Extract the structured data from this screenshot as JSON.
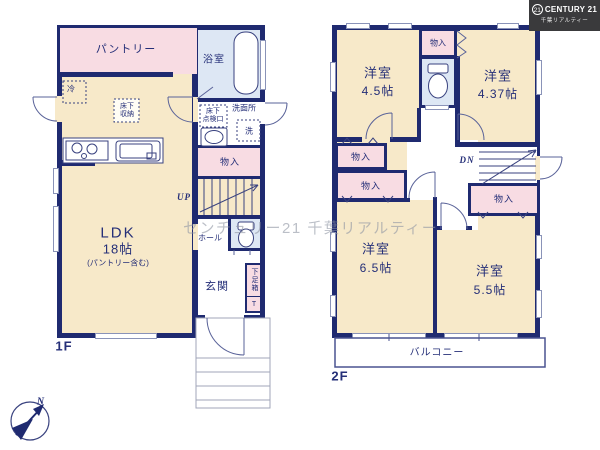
{
  "branding": {
    "badge": "21",
    "name": "CENTURY 21",
    "subtitle": "千葉リアルティー"
  },
  "watermark": {
    "text": "センチュリー21 千葉リアルティー"
  },
  "compass": {
    "north": "N"
  },
  "colors": {
    "wall_navy": "#1f2a70",
    "room_cream": "#f7e9c9",
    "room_pink": "#f8dce3",
    "room_blue": "#dde7f4",
    "logo_bg": "#3a3a3c"
  },
  "f1": {
    "floor_label": "1F",
    "pantry": "パントリー",
    "bath": "浴室",
    "fridge": "冷",
    "underfloor_storage": "床下\n収納",
    "underfloor_hatch": "床下\n点検口",
    "washroom": "洗面所",
    "washer": "洗",
    "closet": "物入",
    "up": "UP",
    "hall": "ホール",
    "ldk_name": "LDK",
    "ldk_size": "18帖",
    "ldk_note": "(パントリー含む)",
    "entrance": "玄関",
    "shoe_box": "下足箱",
    "shoe_box_t": "T"
  },
  "f2": {
    "floor_label": "2F",
    "closet": "物入",
    "dn": "DN",
    "balcony": "バルコニー",
    "rooms": {
      "a": {
        "name": "洋室",
        "size": "4.5帖"
      },
      "b": {
        "name": "洋室",
        "size": "4.37帖"
      },
      "c": {
        "name": "洋室",
        "size": "6.5帖"
      },
      "d": {
        "name": "洋室",
        "size": "5.5帖"
      }
    }
  }
}
